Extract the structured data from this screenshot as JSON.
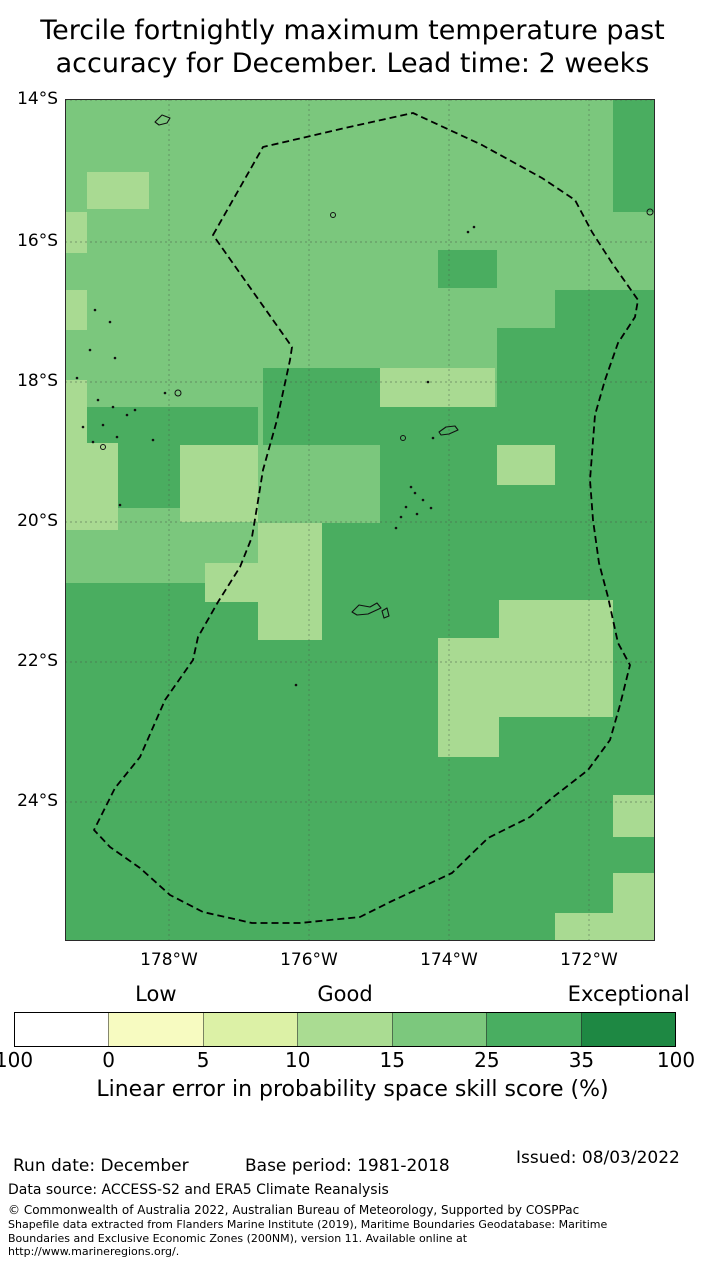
{
  "title": {
    "line1": "Tercile fortnightly maximum temperature past",
    "line2": "accuracy for December. Lead time: 2 weeks"
  },
  "map": {
    "lat_labels": [
      {
        "text": "14°S",
        "y": 100
      },
      {
        "text": "16°S",
        "y": 242
      },
      {
        "text": "18°S",
        "y": 382
      },
      {
        "text": "20°S",
        "y": 522
      },
      {
        "text": "22°S",
        "y": 662
      },
      {
        "text": "24°S",
        "y": 802
      }
    ],
    "lon_labels": [
      {
        "text": "178°W",
        "x": 169
      },
      {
        "text": "176°W",
        "x": 309
      },
      {
        "text": "174°W",
        "x": 449
      },
      {
        "text": "172°W",
        "x": 589
      }
    ],
    "shades": {
      "light": "#a9da92",
      "medium": "#7bc77d",
      "dark": "#4aad60"
    },
    "grid": {
      "vx": [
        104,
        244,
        384,
        524
      ],
      "hy": [
        0,
        142,
        282,
        422,
        562,
        702
      ]
    },
    "dark_patches": [
      [
        548,
        0,
        42,
        112
      ],
      [
        373,
        150,
        59,
        38
      ],
      [
        490,
        190,
        100,
        233
      ],
      [
        432,
        228,
        58,
        195
      ],
      [
        198,
        268,
        117,
        77
      ],
      [
        315,
        307,
        117,
        116
      ],
      [
        22,
        307,
        171,
        38
      ],
      [
        53,
        343,
        62,
        65
      ],
      [
        257,
        423,
        333,
        60
      ],
      [
        0,
        483,
        590,
        359
      ]
    ],
    "light_patches": [
      [
        22,
        72,
        62,
        37
      ],
      [
        0,
        112,
        22,
        41
      ],
      [
        0,
        190,
        22,
        40
      ],
      [
        315,
        268,
        115,
        39
      ],
      [
        0,
        280,
        22,
        63
      ],
      [
        0,
        343,
        53,
        87
      ],
      [
        115,
        345,
        78,
        77
      ],
      [
        432,
        345,
        58,
        40
      ],
      [
        193,
        423,
        64,
        117
      ],
      [
        140,
        463,
        58,
        39
      ],
      [
        434,
        500,
        114,
        117
      ],
      [
        373,
        538,
        61,
        119
      ],
      [
        548,
        695,
        42,
        42
      ],
      [
        548,
        773,
        42,
        68
      ],
      [
        490,
        813,
        58,
        28
      ]
    ],
    "eez_boundary": [
      [
        148,
        135
      ],
      [
        198,
        47
      ],
      [
        280,
        28
      ],
      [
        348,
        13
      ],
      [
        417,
        45
      ],
      [
        477,
        78
      ],
      [
        510,
        100
      ],
      [
        527,
        132
      ],
      [
        547,
        163
      ],
      [
        573,
        200
      ],
      [
        570,
        217
      ],
      [
        553,
        243
      ],
      [
        540,
        280
      ],
      [
        530,
        315
      ],
      [
        525,
        380
      ],
      [
        528,
        420
      ],
      [
        534,
        463
      ],
      [
        543,
        497
      ],
      [
        553,
        543
      ],
      [
        565,
        565
      ],
      [
        555,
        605
      ],
      [
        545,
        640
      ],
      [
        523,
        670
      ],
      [
        487,
        698
      ],
      [
        465,
        717
      ],
      [
        423,
        738
      ],
      [
        387,
        773
      ],
      [
        325,
        802
      ],
      [
        295,
        817
      ],
      [
        235,
        823
      ],
      [
        187,
        823
      ],
      [
        138,
        812
      ],
      [
        105,
        795
      ],
      [
        75,
        768
      ],
      [
        45,
        747
      ],
      [
        29,
        730
      ],
      [
        38,
        712
      ],
      [
        50,
        688
      ],
      [
        75,
        657
      ],
      [
        100,
        600
      ],
      [
        128,
        560
      ],
      [
        133,
        537
      ],
      [
        153,
        502
      ],
      [
        175,
        467
      ],
      [
        187,
        437
      ],
      [
        192,
        407
      ],
      [
        198,
        370
      ],
      [
        212,
        320
      ],
      [
        225,
        260
      ],
      [
        227,
        247
      ]
    ],
    "islands": {
      "dots": [
        [
          30,
          210
        ],
        [
          45,
          222
        ],
        [
          25,
          250
        ],
        [
          50,
          258
        ],
        [
          12,
          278
        ],
        [
          33,
          300
        ],
        [
          48,
          307
        ],
        [
          62,
          315
        ],
        [
          38,
          325
        ],
        [
          52,
          337
        ],
        [
          28,
          342
        ],
        [
          70,
          310
        ],
        [
          88,
          340
        ],
        [
          18,
          327
        ],
        [
          55,
          405
        ],
        [
          100,
          293
        ],
        [
          403,
          132
        ],
        [
          409,
          127
        ],
        [
          363,
          282
        ],
        [
          368,
          338
        ],
        [
          346,
          387
        ],
        [
          350,
          393
        ],
        [
          358,
          400
        ],
        [
          366,
          408
        ],
        [
          352,
          414
        ],
        [
          341,
          407
        ],
        [
          336,
          417
        ],
        [
          331,
          428
        ],
        [
          231,
          585
        ]
      ],
      "circles": [
        [
          113,
          293,
          3
        ],
        [
          268,
          115,
          2.5
        ],
        [
          585,
          112,
          3
        ],
        [
          338,
          338,
          2.5
        ],
        [
          38,
          347,
          2.5
        ]
      ],
      "outlines": [
        "M90,22 l7,-7 l8,3 l-3,5 l-8,2 z",
        "M374,332 l7,-5 l9,-1 l3,4 l-9,4 l-8,1 z",
        "M287,512 l7,-7 l11,2 l7,-4 l4,5 l-13,6 l-11,1 z",
        "M317,511 l5,-3 l2,8 l-5,2 z"
      ]
    }
  },
  "colorbar": {
    "scale_labels": [
      {
        "text": "Low",
        "segment": 1
      },
      {
        "text": "Good",
        "segment": 3
      },
      {
        "text": "Exceptional",
        "segment": 6
      }
    ],
    "segments": [
      "#ffffff",
      "#f7fbc1",
      "#dcf1a6",
      "#aadc92",
      "#7cc87d",
      "#49ae61",
      "#1e8843"
    ],
    "tick_labels": [
      "100",
      "0",
      "5",
      "10",
      "15",
      "25",
      "35",
      "100"
    ],
    "caption": "Linear error in probability space skill score (%)"
  },
  "footer": {
    "run_date": "Run date: December",
    "base_period": "Base period: 1981-2018",
    "issued": "Issued: 08/03/2022",
    "data_source": "Data source: ACCESS-S2 and ERA5 Climate Reanalysis",
    "copyright_lines": [
      "© Commonwealth of Australia 2022, Australian Bureau of Meteorology, Supported by COSPPac",
      "Shapefile data extracted from Flanders Marine Institute (2019), Maritime Boundaries Geodatabase: Maritime",
      "Boundaries and Exclusive Economic Zones (200NM), version 11. Available online at",
      "http://www.marineregions.org/."
    ]
  }
}
